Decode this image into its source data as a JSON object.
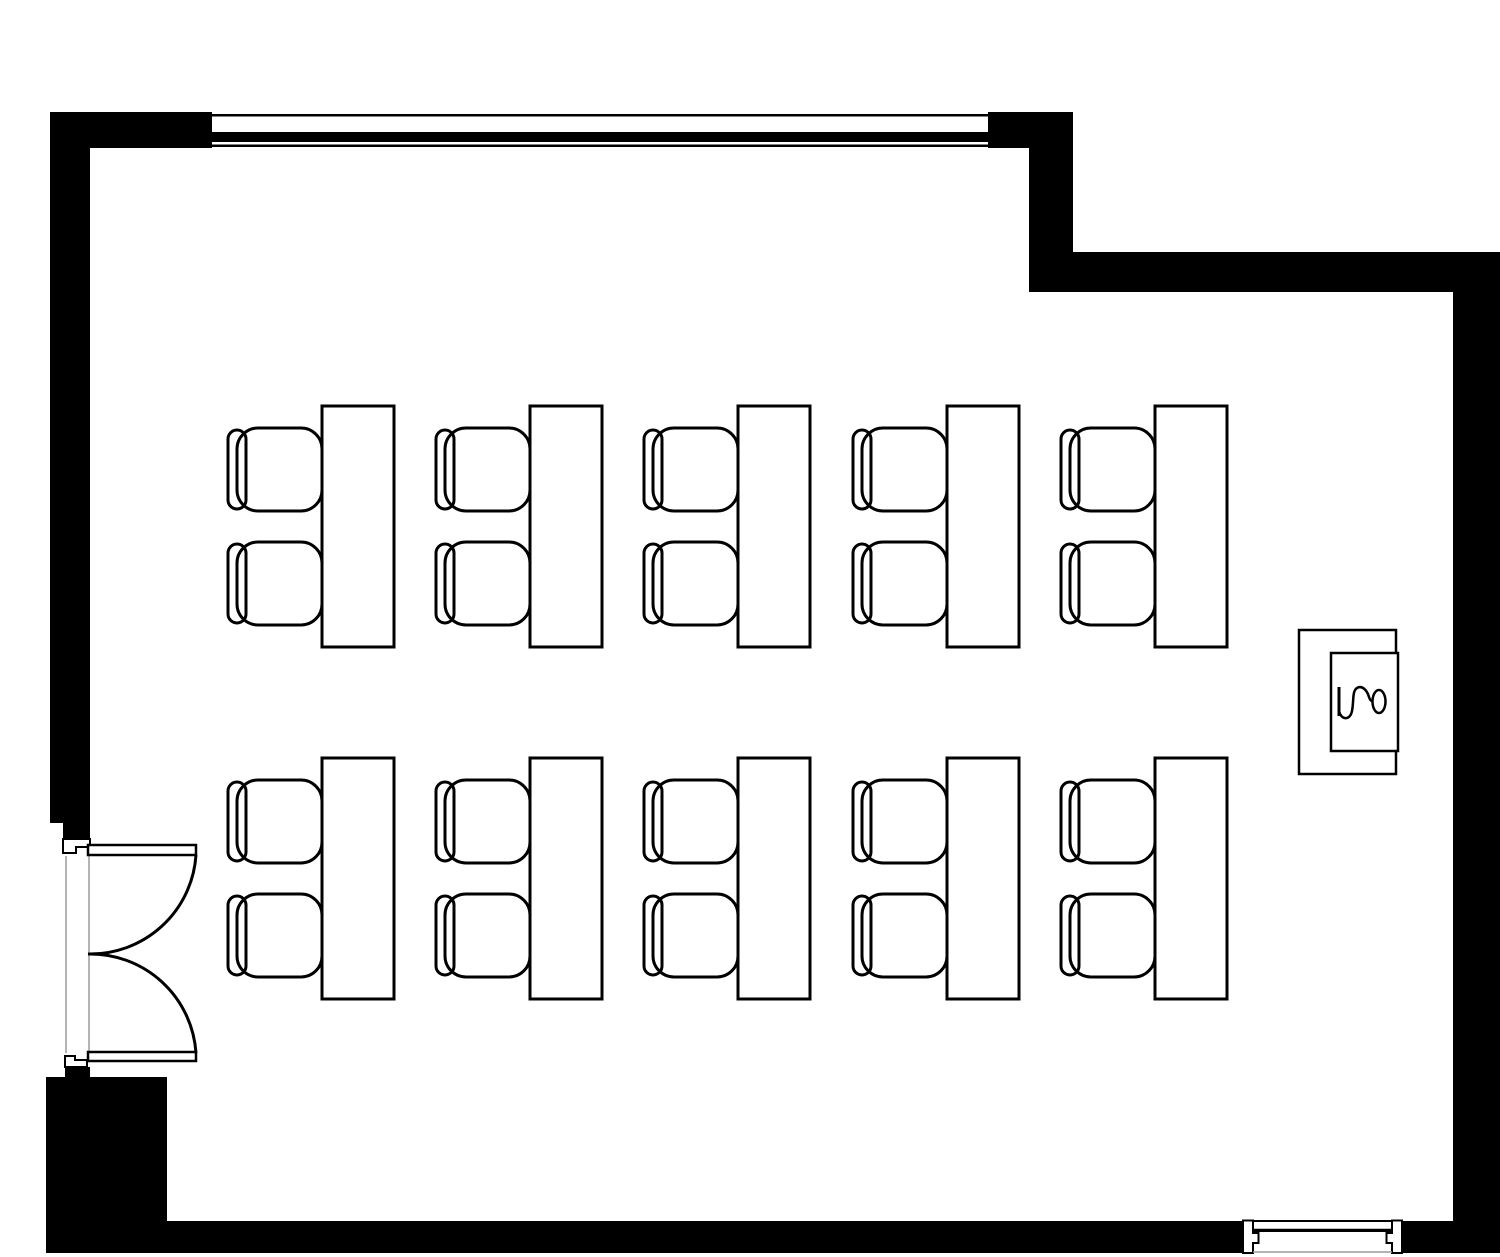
{
  "plan": {
    "width": 1500,
    "height": 1257,
    "colors": {
      "wall": "#000000",
      "paper": "#ffffff",
      "line": "#000000",
      "opening": "#9b9b9b",
      "none": "none"
    },
    "statics": [
      {
        "type": "rect",
        "name": "wall-top-left-segment",
        "x": 50,
        "y": 112,
        "w": 162,
        "h": 36,
        "fill": "wall"
      },
      {
        "type": "rect",
        "name": "wall-top-right-segment",
        "x": 988,
        "y": 112,
        "w": 85,
        "h": 36,
        "fill": "wall"
      },
      {
        "type": "rect",
        "name": "wall-left",
        "x": 50,
        "y": 112,
        "w": 40,
        "h": 711,
        "fill": "wall"
      },
      {
        "type": "rect",
        "name": "wall-step-vertical",
        "x": 1029,
        "y": 148,
        "w": 44,
        "h": 144,
        "fill": "wall"
      },
      {
        "type": "rect",
        "name": "wall-upper-right-horizontal",
        "x": 1029,
        "y": 252,
        "w": 424,
        "h": 40,
        "fill": "wall"
      },
      {
        "type": "rect",
        "name": "wall-right",
        "x": 1453,
        "y": 252,
        "w": 47,
        "h": 1001,
        "fill": "wall"
      },
      {
        "type": "rect",
        "name": "wall-bottom-left-pier",
        "x": 46,
        "y": 1077,
        "w": 121,
        "h": 176,
        "fill": "wall"
      },
      {
        "type": "rect",
        "name": "wall-bottom",
        "x": 167,
        "y": 1221,
        "w": 1076,
        "h": 32,
        "fill": "wall"
      },
      {
        "type": "rect",
        "name": "wall-bottom-right-segment",
        "x": 1402,
        "y": 1221,
        "w": 51,
        "h": 32,
        "fill": "wall"
      },
      {
        "type": "rect",
        "name": "window-top-outer-line",
        "x": 212,
        "y": 114,
        "w": 776,
        "h": 2.5,
        "fill": "wall"
      },
      {
        "type": "rect",
        "name": "window-top-glazing-band",
        "x": 212,
        "y": 132,
        "w": 776,
        "h": 10,
        "fill": "wall"
      },
      {
        "type": "rect",
        "name": "window-top-inner-line",
        "x": 212,
        "y": 144.5,
        "w": 776,
        "h": 2.5,
        "fill": "wall"
      },
      {
        "type": "rect",
        "name": "door-head-black-top",
        "x": 63,
        "y": 823,
        "w": 27,
        "h": 17,
        "fill": "wall"
      },
      {
        "type": "rect",
        "name": "door-head-black-bottom",
        "x": 65,
        "y": 1067,
        "w": 25,
        "h": 10,
        "fill": "wall"
      },
      {
        "type": "line",
        "name": "door-opening-line-outer",
        "x1": 66,
        "y1": 856,
        "x2": 66,
        "y2": 1053,
        "stroke": "opening",
        "sw": 1.5
      },
      {
        "type": "line",
        "name": "door-opening-line-inner",
        "x1": 89,
        "y1": 856,
        "x2": 89,
        "y2": 1053,
        "stroke": "opening",
        "sw": 1.5
      },
      {
        "type": "path",
        "name": "door-jamb-top",
        "d": "M63,839 L90,839 L90,847 L76,847 L76,853 L63,853 Z",
        "fill": "paper",
        "stroke": "line",
        "sw": 2
      },
      {
        "type": "path",
        "name": "door-jamb-bottom",
        "d": "M65,1067 L65,1056 L75,1056 L75,1060 L87,1060 L87,1067 Z",
        "fill": "paper",
        "stroke": "line",
        "sw": 2
      },
      {
        "type": "rect",
        "name": "door-leaf-top",
        "x": 88,
        "y": 845,
        "w": 108,
        "h": 10,
        "fill": "paper",
        "stroke": "line",
        "sw": 2.5
      },
      {
        "type": "rect",
        "name": "door-leaf-bottom",
        "x": 88,
        "y": 1052,
        "w": 108,
        "h": 9,
        "fill": "paper",
        "stroke": "line",
        "sw": 2.5
      },
      {
        "type": "path",
        "name": "door-swing-arc-top",
        "d": "M196,855 A106,106 0 0 1 88,954",
        "fill": "none",
        "stroke": "line",
        "sw": 3
      },
      {
        "type": "path",
        "name": "door-swing-arc-bottom",
        "d": "M196,1053 A106,106 0 0 0 88,954",
        "fill": "none",
        "stroke": "line",
        "sw": 3
      },
      {
        "type": "rect",
        "name": "fixture-outer-box",
        "x": 1299,
        "y": 630,
        "w": 97,
        "h": 144,
        "fill": "paper",
        "stroke": "line",
        "sw": 2.5
      },
      {
        "type": "rect",
        "name": "fixture-inner-box",
        "x": 1331,
        "y": 653,
        "w": 67,
        "h": 98,
        "fill": "paper",
        "stroke": "line",
        "sw": 2.5
      },
      {
        "type": "line",
        "name": "fixture-glyph-bar",
        "x1": 1339,
        "y1": 687,
        "x2": 1339,
        "y2": 716,
        "stroke": "line",
        "sw": 3
      },
      {
        "type": "path",
        "name": "fixture-glyph-wave",
        "d": "M1339,711 C1341,720 1350,721 1352,711 C1354,701 1352,691 1357,688 C1362,685 1367,690 1369,697 C1370,700 1371,701 1372,701",
        "fill": "none",
        "stroke": "line",
        "sw": 2.5
      },
      {
        "type": "ellipse",
        "name": "fixture-glyph-ring",
        "cx": 1379,
        "cy": 701.5,
        "rx": 6.5,
        "ry": 11.5,
        "fill": "none",
        "stroke": "line",
        "sw": 2.5
      },
      {
        "type": "path",
        "name": "window-bottom-jamb-left",
        "d": "M1243,1220.5 L1253,1220.5 L1253,1233 L1258.5,1233 L1258.5,1243 L1253,1243 L1253,1253 L1243,1253 Z",
        "fill": "paper",
        "stroke": "line",
        "sw": 2
      },
      {
        "type": "path",
        "name": "window-bottom-jamb-right",
        "d": "M1402,1220.5 L1392,1220.5 L1392,1233 L1386.5,1233 L1386.5,1243 L1392,1243 L1392,1253 L1402,1253 Z",
        "fill": "paper",
        "stroke": "line",
        "sw": 2
      },
      {
        "type": "rect",
        "name": "window-bottom-frame",
        "x": 1253,
        "y": 1221,
        "w": 139,
        "h": 10,
        "fill": "paper",
        "stroke": "line",
        "sw": 2
      },
      {
        "type": "line",
        "name": "window-bottom-frame-line",
        "x1": 1253,
        "y1": 1229.5,
        "x2": 1392,
        "y2": 1229.5,
        "stroke": "line",
        "sw": 1.5
      },
      {
        "type": "line",
        "name": "window-bottom-sill-line",
        "x1": 1253,
        "y1": 1252,
        "x2": 1392,
        "y2": 1252,
        "stroke": "opening",
        "sw": 1.5
      }
    ],
    "furniture": {
      "rows_y": [
        406,
        758
      ],
      "desks_x": [
        322,
        530,
        738,
        947,
        1155
      ],
      "desk": {
        "w": 72,
        "h": 241,
        "sw": 3
      },
      "chair": {
        "seat_dx": -85,
        "seat_w": 85,
        "seat_h": 83,
        "seat_rx": 21,
        "back_dx": -94,
        "back_w": 18,
        "back_h": 79,
        "back_rx": 9,
        "dy": [
          22,
          136
        ],
        "sw": 3
      },
      "counts": {
        "rows": 2,
        "desks_per_row": 5,
        "chairs_per_desk": 2
      }
    }
  }
}
